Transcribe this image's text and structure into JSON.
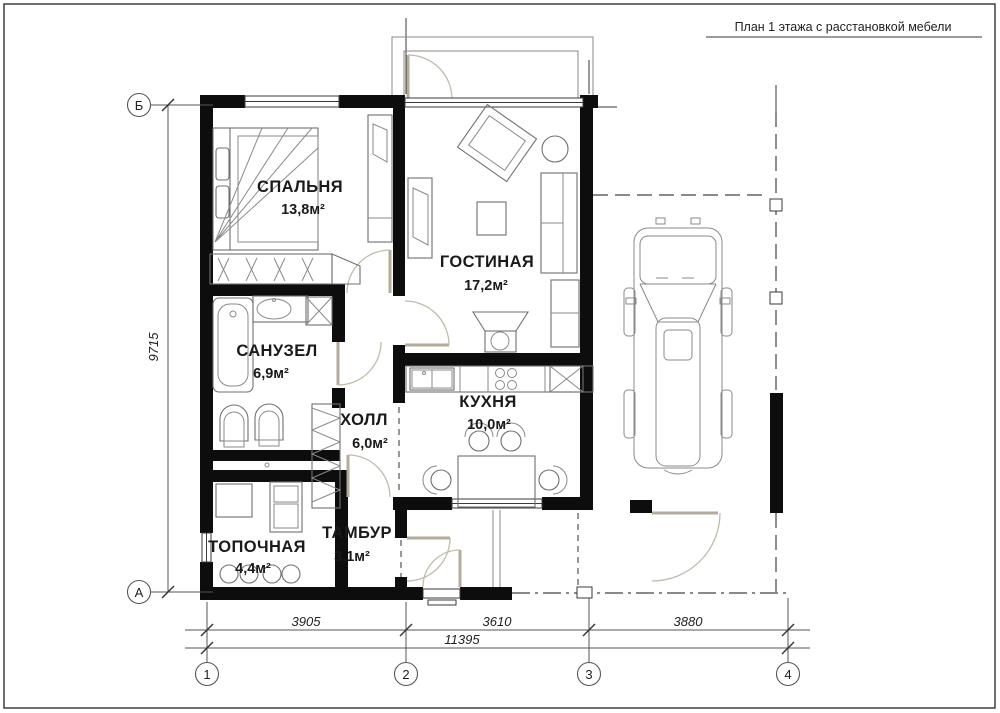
{
  "title": "План 1 этажа с расстановкой мебели",
  "rooms": [
    {
      "name": "СПАЛЬНЯ",
      "area": "13,8м²"
    },
    {
      "name": "ГОСТИНАЯ",
      "area": "17,2м²"
    },
    {
      "name": "САНУЗЕЛ",
      "area": "6,9м²"
    },
    {
      "name": "ХОЛЛ",
      "area": "6,0м²"
    },
    {
      "name": "КУХНЯ",
      "area": "10,0м²"
    },
    {
      "name": "ТАМБУР",
      "area": "3,1м²"
    },
    {
      "name": "ТОПОЧНАЯ",
      "area": "4,4м²"
    }
  ],
  "dimensions": {
    "left_height": "9715",
    "bottom_segments": [
      "3905",
      "3610",
      "3880"
    ],
    "bottom_total": "11395"
  },
  "axes": {
    "horizontal": [
      "1",
      "2",
      "3",
      "4"
    ],
    "vertical": [
      "Б",
      "А"
    ]
  },
  "colors": {
    "wall": "#0d0d0d",
    "furniture_stroke": "#707070",
    "background": "#ffffff"
  }
}
